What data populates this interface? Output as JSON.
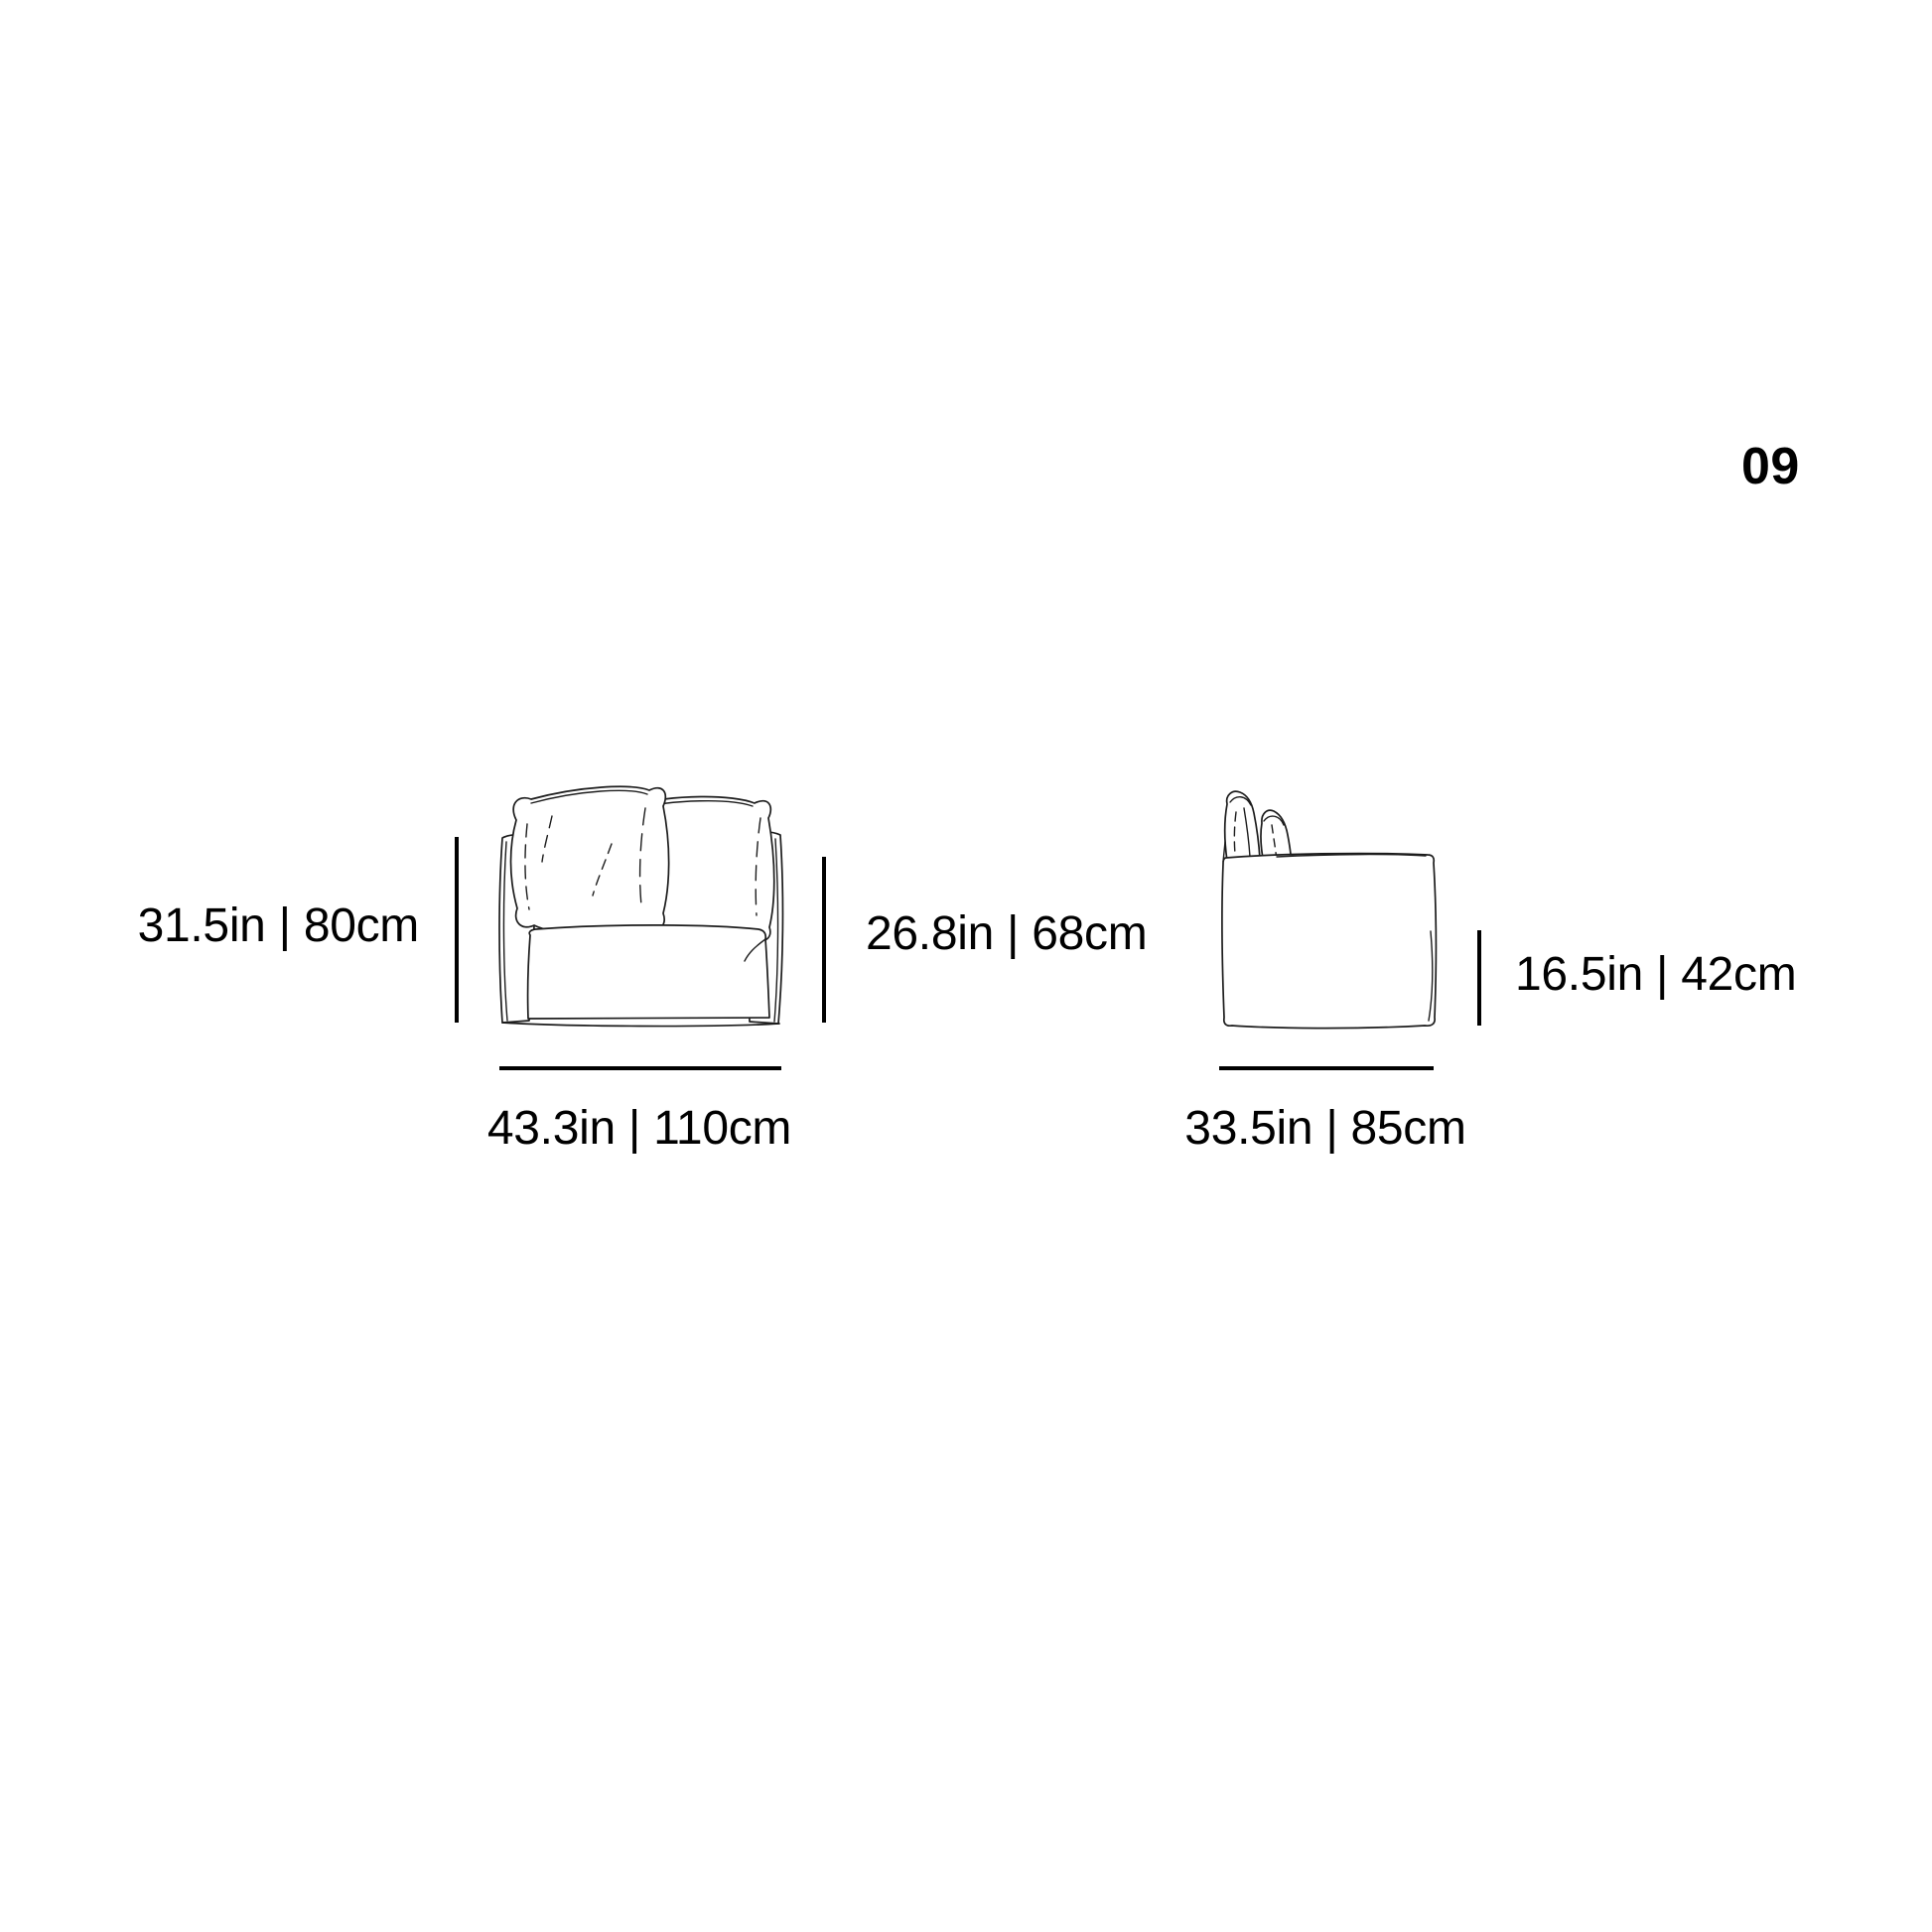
{
  "page": {
    "number": "09"
  },
  "style": {
    "ink": "#000000",
    "sketch_ink": "#1c1c1c",
    "background": "#ffffff"
  },
  "front_view": {
    "height_label": "31.5in | 80cm",
    "back_height_label": "26.8in | 68cm",
    "width_label": "43.3in | 110cm"
  },
  "side_view": {
    "seat_height_label": "16.5in | 42cm",
    "depth_label": "33.5in | 85cm"
  }
}
